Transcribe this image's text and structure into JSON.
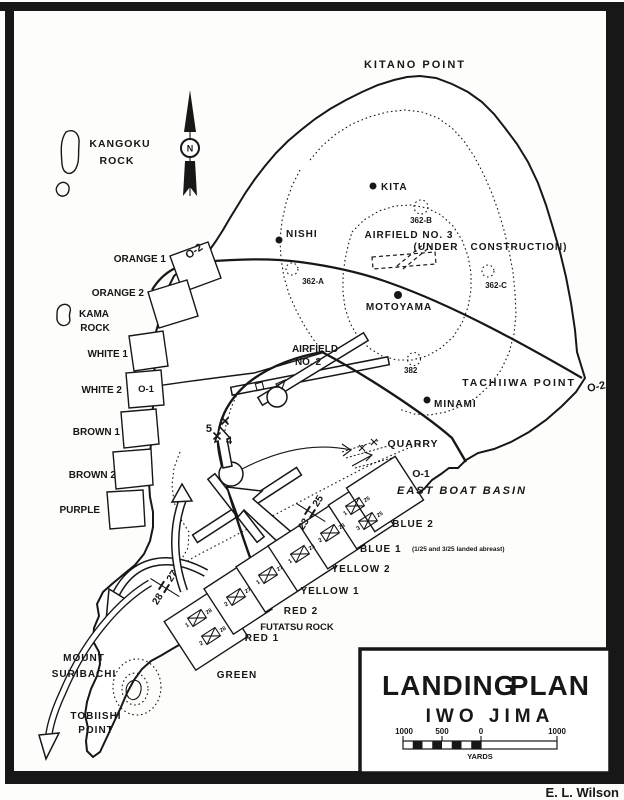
{
  "frame": {
    "signature": "E. L. Wilson"
  },
  "title_block": {
    "word1": "LANDING",
    "word2": "PLAN",
    "line2": "IWO JIMA",
    "scale_labels": [
      "1000",
      "500",
      "0",
      "1000"
    ],
    "scale_units": "YARDS"
  },
  "compass": {
    "n": "N"
  },
  "phase_lines": {
    "o2_west": "O-2",
    "o2_east": "O-2",
    "o1_west": "O-1",
    "o1_east": "O-1"
  },
  "boundaries": {
    "green_red": {
      "left": "28",
      "right": "27"
    },
    "yellow_blue": {
      "left": "23",
      "right": "25"
    },
    "division": {
      "left": "5",
      "right": "4"
    }
  },
  "places": {
    "kitano": "KITANO POINT",
    "kangoku_line1": "KANGOKU",
    "kangoku_line2": "ROCK",
    "kama_line1": "KAMA",
    "kama_line2": "ROCK",
    "kita": "KITA",
    "nishi": "NISHI",
    "motoyama": "MOTOYAMA",
    "minami": "MINAMI",
    "airfield3_line1": "AIRFIELD NO. 3",
    "airfield3_line2": "(UNDER",
    "airfield3_line3": "CONSTRUCTION)",
    "airfield2_line1": "AIRFIELD",
    "airfield2_line2": "NO. 2",
    "hill_362a": "362-A",
    "hill_362b": "362-B",
    "hill_362c": "362-C",
    "hill_382": "382",
    "tachiiwa": "TACHIIWA POINT",
    "quarry": "QUARRY",
    "east_boat_basin": "EAST BOAT BASIN",
    "mount": "MOUNT",
    "suribachi": "SURIBACHI",
    "tobiishi_line1": "TOBIISHI",
    "tobiishi_line2": "POINT"
  },
  "beaches_west": [
    "ORANGE 1",
    "ORANGE 2",
    "WHITE 1",
    "WHITE 2",
    "BROWN 1",
    "BROWN 2",
    "PURPLE"
  ],
  "beaches_south": {
    "green": "GREEN",
    "red1": "RED 1",
    "red2": "RED 2",
    "futatsu": "FUTATSU ROCK",
    "yellow1": "YELLOW 1",
    "yellow2": "YELLOW 2",
    "blue1": "BLUE 1",
    "blue1_note": "(1/25 and 3/25 landed abreast)",
    "blue2": "BLUE 2"
  },
  "units": [
    {
      "bn": "1",
      "regt": "28"
    },
    {
      "bn": "2",
      "regt": "28"
    },
    {
      "bn": "2",
      "regt": "27"
    },
    {
      "bn": "1",
      "regt": "27"
    },
    {
      "bn": "1",
      "regt": "23"
    },
    {
      "bn": "2",
      "regt": "23"
    },
    {
      "bn": "1",
      "regt": "25"
    },
    {
      "bn": "3",
      "regt": "25"
    }
  ],
  "colors": {
    "ink": "#171717",
    "paper": "#fdfdfb"
  }
}
